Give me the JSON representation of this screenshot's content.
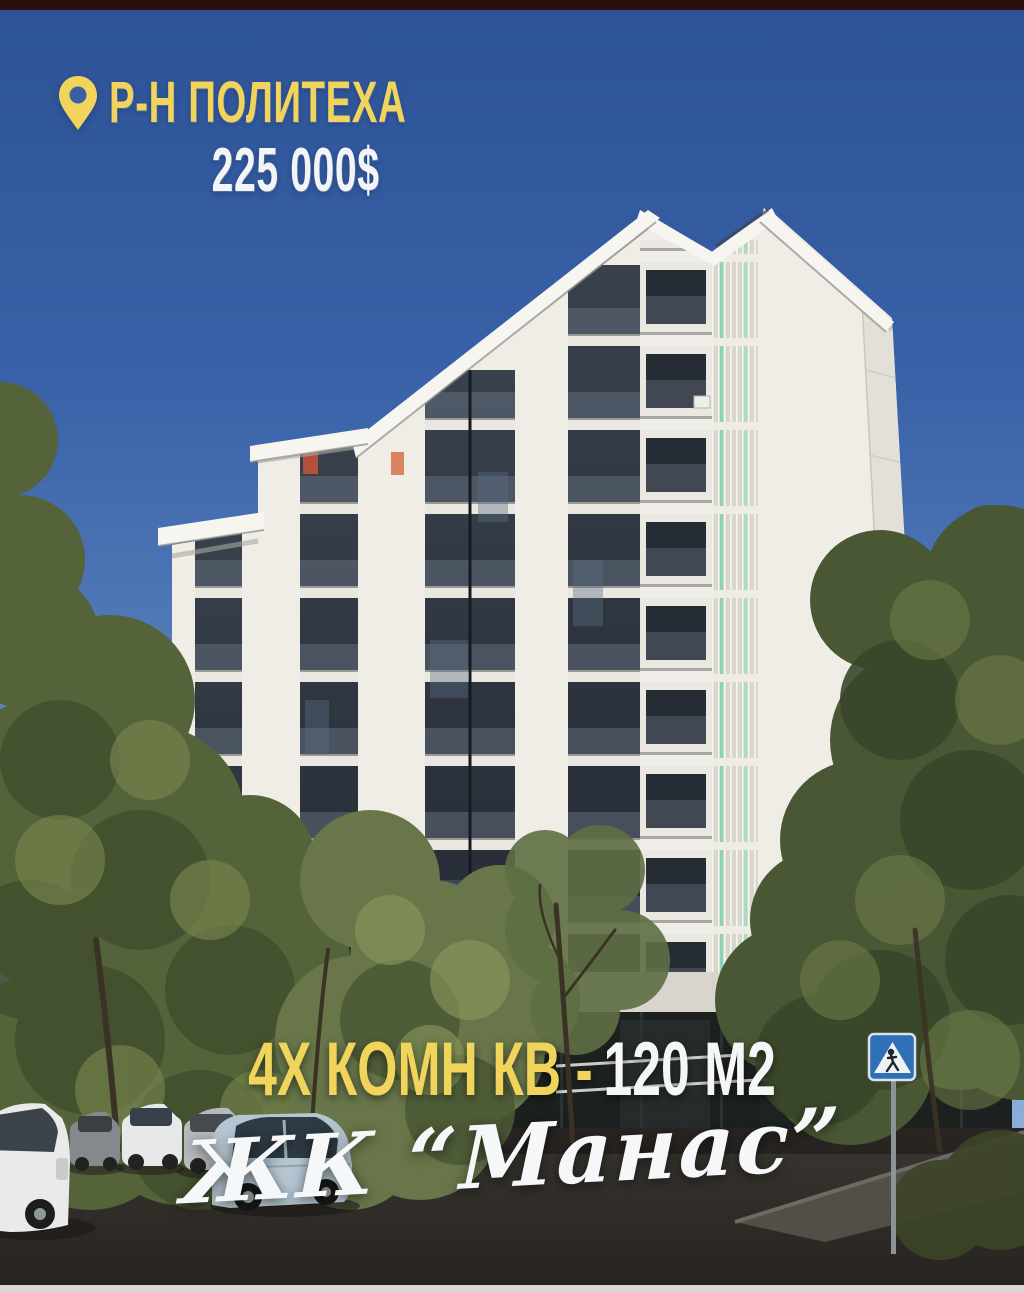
{
  "colors": {
    "accent_yellow": "#f0d45c",
    "text_white": "#f5f6f7",
    "sky_top": "#2d5296",
    "sky_bottom": "#a5c3e4"
  },
  "overlay": {
    "location_label": "Р-Н ПОЛИТЕХА",
    "price": "225 000$",
    "listing_spec_yellow": "4Х КОМН КВ -",
    "listing_spec_white": "120 М2",
    "complex_name": "ЖК “Манас”"
  },
  "photo": {
    "storefront_sign_label": "4D"
  }
}
